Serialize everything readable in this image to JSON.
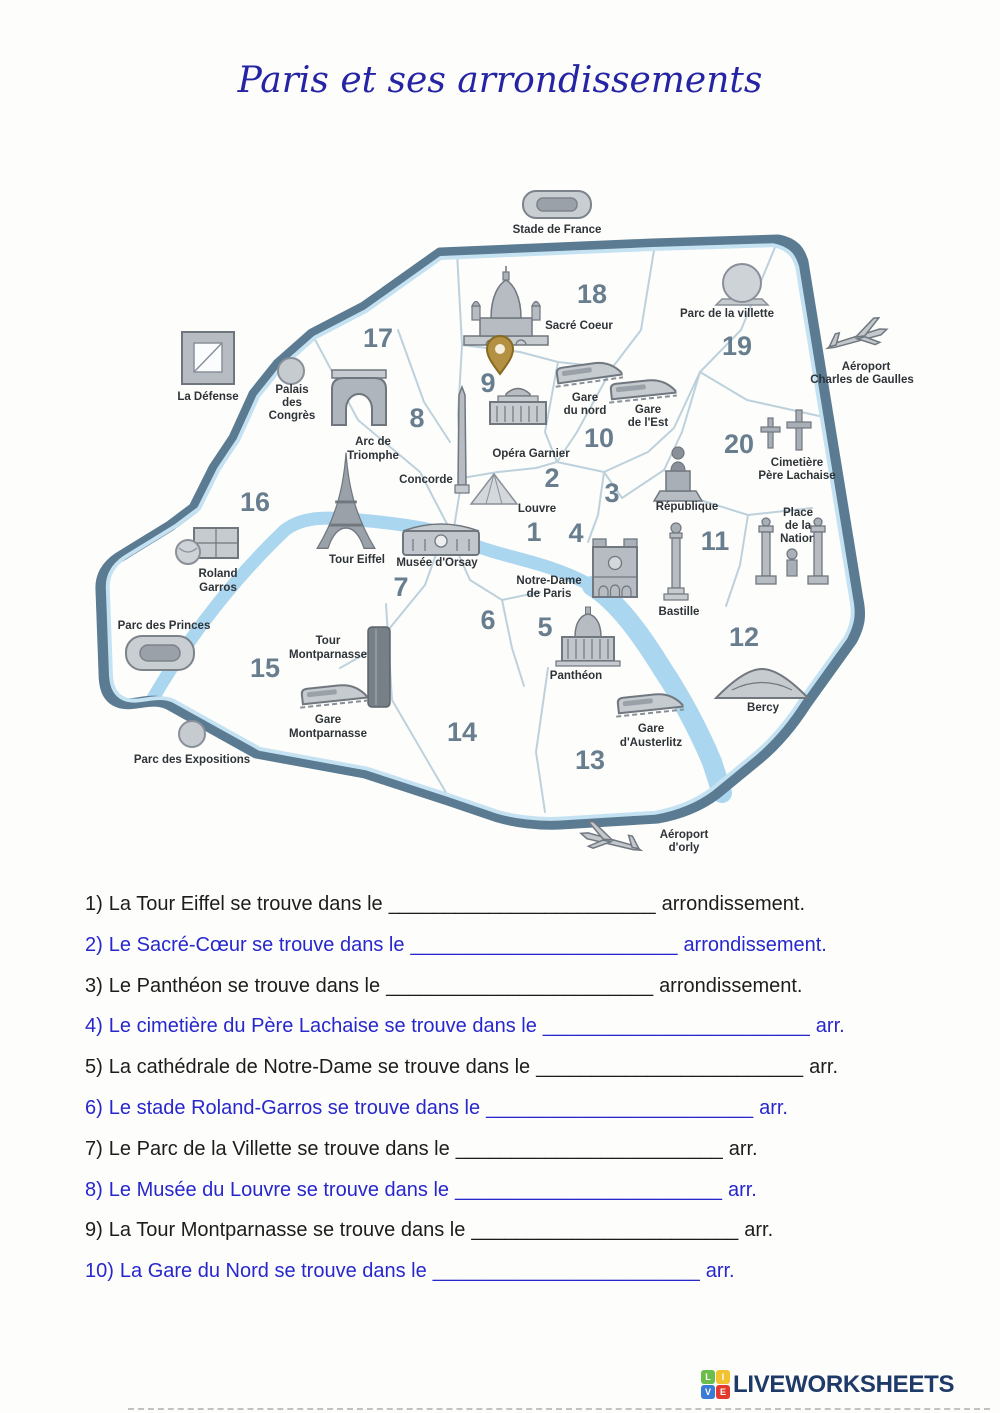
{
  "title": "Paris et ses arrondissements",
  "colors": {
    "title_blue": "#2424a4",
    "question_black": "#1d1d1d",
    "question_blue": "#2727cd",
    "ring": "#5a7b91",
    "ring_inner": "#c5e2f2",
    "seine": "#abd6ef",
    "district_number": "#61788a",
    "brand_navy": "#1e3a68",
    "tile_l_green": "#6abf4b",
    "tile_i_yellow": "#f2c230",
    "tile_v_blue": "#3a7bd5",
    "tile_e_red": "#e23b2e",
    "pin_gold": "#b49043"
  },
  "map": {
    "districts": [
      "1",
      "2",
      "3",
      "4",
      "5",
      "6",
      "7",
      "8",
      "9",
      "10",
      "11",
      "12",
      "13",
      "14",
      "15",
      "16",
      "17",
      "18",
      "19",
      "20"
    ],
    "landmarks": [
      {
        "id": "stade-de-france",
        "lines": [
          "Stade de France"
        ]
      },
      {
        "id": "la-defense",
        "lines": [
          "La Défense"
        ]
      },
      {
        "id": "palais-des-congres",
        "lines": [
          "Palais",
          "des",
          "Congrès"
        ]
      },
      {
        "id": "arc-de-triomphe",
        "lines": [
          "Arc de",
          "Triomphe"
        ]
      },
      {
        "id": "sacre-coeur",
        "lines": [
          "Sacré Coeur"
        ]
      },
      {
        "id": "parc-de-la-villette",
        "lines": [
          "Parc de la villette"
        ]
      },
      {
        "id": "aeroport-cdg",
        "lines": [
          "Aéroport",
          "Charles de Gaulles"
        ]
      },
      {
        "id": "gare-du-nord",
        "lines": [
          "Gare",
          "du nord"
        ]
      },
      {
        "id": "gare-de-lest",
        "lines": [
          "Gare",
          "de l'Est"
        ]
      },
      {
        "id": "opera-garnier",
        "lines": [
          "Opéra Garnier"
        ]
      },
      {
        "id": "concorde",
        "lines": [
          "Concorde"
        ]
      },
      {
        "id": "pere-lachaise",
        "lines": [
          "Cimetière",
          "Père Lachaise"
        ]
      },
      {
        "id": "louvre",
        "lines": [
          "Louvre"
        ]
      },
      {
        "id": "republique",
        "lines": [
          "République"
        ]
      },
      {
        "id": "place-de-la-nation",
        "lines": [
          "Place",
          "de la",
          "Nation"
        ]
      },
      {
        "id": "tour-eiffel",
        "lines": [
          "Tour Eiffel"
        ]
      },
      {
        "id": "musee-dorsay",
        "lines": [
          "Musée d'Orsay"
        ]
      },
      {
        "id": "notre-dame",
        "lines": [
          "Notre-Dame",
          "de Paris"
        ]
      },
      {
        "id": "bastille",
        "lines": [
          "Bastille"
        ]
      },
      {
        "id": "roland-garros",
        "lines": [
          "Roland",
          "Garros"
        ]
      },
      {
        "id": "parc-des-princes",
        "lines": [
          "Parc des Princes"
        ]
      },
      {
        "id": "tour-montparnasse",
        "lines": [
          "Tour",
          "Montparnasse"
        ]
      },
      {
        "id": "gare-montparnasse",
        "lines": [
          "Gare",
          "Montparnasse"
        ]
      },
      {
        "id": "pantheon",
        "lines": [
          "Panthéon"
        ]
      },
      {
        "id": "bercy",
        "lines": [
          "Bercy"
        ]
      },
      {
        "id": "gare-austerlitz",
        "lines": [
          "Gare",
          "d'Austerlitz"
        ]
      },
      {
        "id": "parc-des-expositions",
        "lines": [
          "Parc des Expositions"
        ]
      },
      {
        "id": "aeroport-orly",
        "lines": [
          "Aéroport",
          "d'orly"
        ]
      }
    ]
  },
  "questions": [
    {
      "label": "1)",
      "text": "La Tour Eiffel se trouve dans le",
      "blank": "________________________",
      "suffix": "arrondissement.",
      "color": "black"
    },
    {
      "label": "2)",
      "text": "Le Sacré-Cœur se trouve dans le",
      "blank": "________________________",
      "suffix": "arrondissement.",
      "color": "blue"
    },
    {
      "label": "3)",
      "text": "Le Panthéon se trouve dans le",
      "blank": "________________________",
      "suffix": "arrondissement.",
      "color": "black"
    },
    {
      "label": "4)",
      "text": "Le cimetière du Père Lachaise se trouve dans le",
      "blank": "________________________",
      "suffix": "arr.",
      "color": "blue"
    },
    {
      "label": "5)",
      "text": "La cathédrale de Notre-Dame se trouve dans le",
      "blank": "________________________",
      "suffix": "arr.",
      "color": "black"
    },
    {
      "label": "6)",
      "text": "Le stade Roland-Garros se trouve dans le",
      "blank": "________________________",
      "suffix": "arr.",
      "color": "blue"
    },
    {
      "label": "7)",
      "text": "Le Parc de la Villette se trouve dans le",
      "blank": "________________________",
      "suffix": "arr.",
      "color": "black"
    },
    {
      "label": "8)",
      "text": "Le Musée du Louvre se trouve dans le",
      "blank": "________________________",
      "suffix": "arr.",
      "color": "blue"
    },
    {
      "label": "9)",
      "text": "La Tour Montparnasse se trouve dans le",
      "blank": "________________________",
      "suffix": "arr.",
      "color": "black"
    },
    {
      "label": "10)",
      "text": "La Gare du Nord se trouve dans le",
      "blank": "________________________",
      "suffix": "arr.",
      "color": "blue"
    }
  ],
  "footer": {
    "brand": "LIVEWORKSHEETS",
    "tiles": [
      "L",
      "I",
      "V",
      "E"
    ]
  }
}
